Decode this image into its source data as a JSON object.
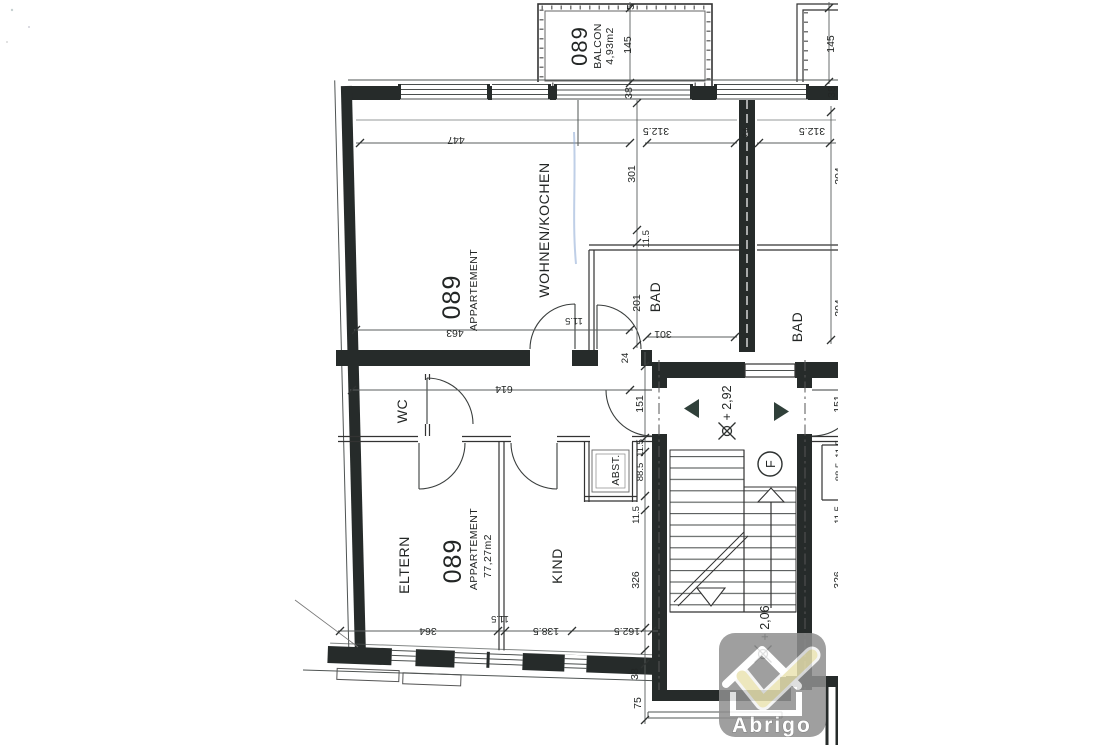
{
  "labels": {
    "balcony": {
      "number": "089",
      "name": "BALCON",
      "area": "4,93m2"
    },
    "upper_apartment": {
      "number": "089",
      "type": "APPARTEMENT",
      "living_kitchen": "WOHNEN/KOCHEN",
      "bath": "BAD"
    },
    "lower_apartment": {
      "number": "089",
      "type": "APPARTEMENT",
      "area": "77,27m2",
      "wc": "WC",
      "storage": "ABST.",
      "parents": "ELTERN",
      "child": "KIND"
    },
    "neighbor_apartment": {
      "bath": "BAD"
    },
    "stairwell": {
      "upper_level": "+ 2,92",
      "lower_level": "+ 2,06",
      "elevator": "F"
    }
  },
  "dimensions": {
    "top_cut": "5",
    "balcony_height": "145",
    "top_wall": "38",
    "living_width": "447",
    "hall_upper_left": "312.5",
    "separating_wall": "24",
    "hall_upper_right": "312.5",
    "living_height": "301",
    "wall_a": "11.5",
    "bath_height": "201",
    "lower_width": "463",
    "entry_width": "11.5",
    "bath_width": "301",
    "entry_wall": "24",
    "hall_width": "614",
    "hall_height": "151",
    "storage_wall": "11.5",
    "storage_height": "88.5",
    "wall_b": "11.5",
    "child_height": "326",
    "parents_width": "364",
    "partition": "11.5",
    "child_width": "138.5",
    "stair_width": "162.5",
    "base_wall": "38",
    "base_offset": "75",
    "balcony2_height": "145",
    "balcony2_wall": "38",
    "n_dim_a": "204",
    "n_dim_b": "204",
    "n_hall_height": "151",
    "n_wall_a": "11.5",
    "n_storage_height": "88.5",
    "n_wall_b": "11.5",
    "n_child_height": "326"
  },
  "watermark": {
    "brand": "Abrigo"
  },
  "colors": {
    "wall": "#262b2a",
    "line": "#4f5453",
    "text": "#232625",
    "logo_gray": "#8f8f8f",
    "logo_check": "#eae3b2",
    "pen_mark_blue": "#7fa0cf"
  }
}
